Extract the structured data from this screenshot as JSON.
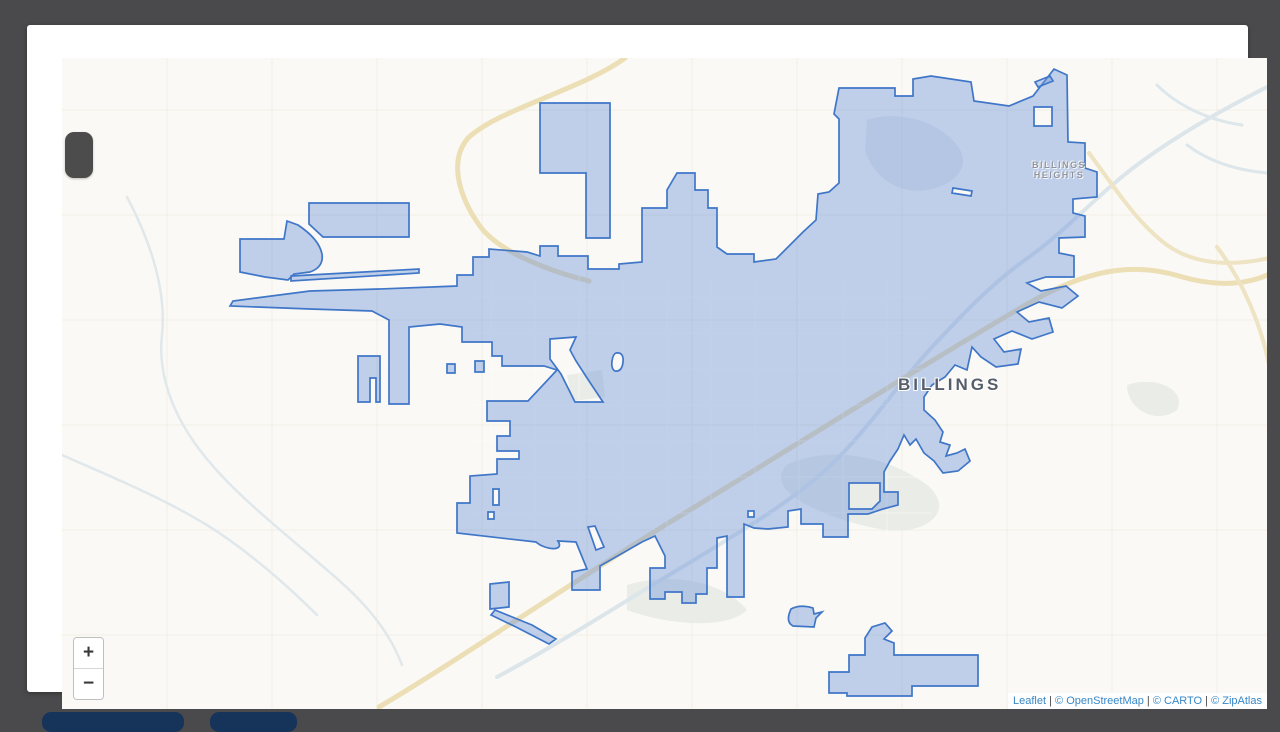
{
  "theme": {
    "page-bg": "#4a4a4c",
    "card-bg": "#ffffff",
    "map-bg": "#faf9f5",
    "poly-fill": "rgba(110,148,216,0.42)",
    "poly-stroke": "#3f76c8",
    "label-dark": "#565e6a",
    "label-light": "#8f949c",
    "link-blue": "#3687c8",
    "btn-navy": "#16335a",
    "pill-gray": "#4c4c4c"
  },
  "map": {
    "city_label": "BILLINGS",
    "heights_label": "BILLINGS\nHEIGHTS",
    "zoom_control": {
      "zoom_in_label": "+",
      "zoom_out_label": "−"
    },
    "attribution": {
      "parts": [
        {
          "text": "Leaflet",
          "link": true
        },
        {
          "text": " | ",
          "link": false
        },
        {
          "text": "© OpenStreetMap",
          "link": true
        },
        {
          "text": " | ",
          "link": false
        },
        {
          "text": "© CARTO",
          "link": true
        },
        {
          "text": " | ",
          "link": false
        },
        {
          "text": "© ZipAtlas",
          "link": true
        }
      ]
    },
    "layers": [
      {
        "name": "section-grid-lines",
        "d": "M140 33V684M245 33V684M350 33V684M455 33V684M560 33V684M665 33V684M770 33V684M875 33V684M980 33V684M1085 33V684M1190 33V684M35 85H1240M35 190H1240M35 295H1240M35 400H1240M35 505H1240M35 610H1240",
        "stroke": "#f1eee5",
        "w": 1
      },
      {
        "name": "land-patches",
        "d": "M760 440C800 420 860 430 900 460C930 485 900 510 860 505C820 500 730 470 760 440Z M540 350L575 345 578 372 545 376Z M600 560C650 545 700 560 720 585C700 605 640 600 600 585Z M1100 360C1130 350 1160 365 1150 385C1130 400 1100 385 1100 360Z",
        "fill": "#e9ece7"
      },
      {
        "name": "terrain-rimrocks",
        "d": "M840 95C870 85 910 95 930 120C945 140 930 160 900 165C870 170 845 150 838 125Z",
        "fill": "#ccd6e0",
        "op": "0.4"
      },
      {
        "name": "river-yellowstone",
        "d": "M1248 58C1200 82 1150 110 1110 140C1070 170 1040 205 1002 232C965 258 935 290 905 322C875 354 848 395 812 432C776 469 725 500 662 538C600 575 530 620 470 652",
        "stroke": "#dce6ea",
        "w": 4
      },
      {
        "name": "river-west-creeks",
        "d": "M100 172C120 210 140 260 135 310C130 355 150 400 185 440C215 475 260 510 300 545C330 570 360 600 375 640 M35 430C80 450 130 470 180 500C220 525 260 560 290 590",
        "stroke": "#e0e8ec",
        "w": 2.5
      },
      {
        "name": "river-ne-braids",
        "d": "M1130 60C1150 80 1180 95 1215 100 M1160 120C1180 135 1205 145 1240 148",
        "stroke": "#dde7eb",
        "w": 3
      },
      {
        "name": "highway-main",
        "d": "M598 33C556 64 472 84 441 113C419 139 436 180 456 205C476 228 522 246 562 256 M352 682C430 636 531 566 648 494C766 422 902 336 1002 278C1056 247 1102 236 1152 251C1196 264 1228 258 1248 246",
        "stroke": "#ecdfb5",
        "w": 5
      },
      {
        "name": "highway-northeast",
        "d": "M1062 128C1088 163 1110 198 1140 220C1168 240 1205 242 1247 232 M1190 222C1215 255 1235 300 1243 345",
        "stroke": "#eee3c2",
        "w": 4
      },
      {
        "name": "street-grid",
        "d": "M464 250V515M508 250V515M552 250V515M596 250V515M640 250V515M684 250V515M728 250V515M772 250V515M816 250V515M860 250V515M440 272H905M440 308H905M440 344H905M440 380H905M440 416H905M440 452H905M440 488H905",
        "stroke": "#ffffff",
        "w": 1.1,
        "op": "0.45"
      },
      {
        "name": "city-boundary-polygon",
        "d": "M203 281L206 276 283 266 352 264 430 261 430 250 446 250 446 232 462 232 462 224 500 227 513 231 513 221 531 221 531 231 561 231 561 244 592 244 592 239 615 237 615 183 640 183 640 165 650 148 668 148 668 165 681 165 681 183 690 183 690 222 700 229 727 229 727 237 749 234 762 221 776 207 789 195 791 169 802 167 812 158 812 94 807 89 812 63 868 63 868 71 886 71 886 54 904 51 944 57 947 76 982 81 1006 71 1027 44 1040 50 1041 117 1058 118 1058 143 1070 147 1070 172 1046 174 1046 188 1058 191 1058 212 1032 213 1032 228 1047 231 1047 252 1019 252 1000 258 1014 266 1039 261 1051 271 1035 283 1012 277 990 287 1002 297 1022 293 1026 307 1005 314 985 306 967 314 977 327 994 324 991 339 969 342 954 332 945 322 940 345 928 340 918 352 905 360 897 372 897 385 908 395 916 407 913 417 923 420 919 431 930 428 938 424 943 436 931 446 916 448 907 436 897 428 889 414 883 420 877 410 871 424 863 436 857 447 857 467 871 467 871 480 856 484 841 489 821 489 821 512 796 512 796 499 774 499 774 484 761 486 761 502 741 504 727 503 717 499 717 572 700 572 700 511 690 513 690 543 680 543 680 569 669 569 669 578 655 578 655 567 638 567 638 574 623 574 623 543 638 543 638 531 628 511 615 517 573 541 573 565 545 565 545 547 560 544 549 517 531 516C538 527 518 525 509 517L430 508 430 478 443 478 443 451 470 449 470 434 492 434 492 426 470 426 470 411 483 411 483 396 460 396 460 376 501 376 530 345 517 341 475 341 475 331 465 331 465 317 435 317 435 302 413 299 382 302 382 379 362 379 362 295 345 286 283 284Z M523 314L549 312 543 325 549 336 562 356 576 377 548 377 534 349 523 334Z M589 328Q597 327 596 337Q595 347 588 346Q584 344 585 336Q586 329 589 328Z M420 339H428V348H420Z M448 336H457V347H448Z M466 464H472V480H466Z M461 487H467V494H461Z M561 502L568 501 577 522 569 525Z M721 486H727V492H721Z M822 458H853V476L845 484H822Z M1007 82H1025V101H1007Z M926 163L945 166 944 171 925 168Z",
        "fill": "rgba(110,148,216,0.42)",
        "stroke": "#3f76c8",
        "w": 1.7,
        "rule": "evenodd"
      },
      {
        "name": "city-boundary-exclaves",
        "d": "M513 78H583V213H559V148H513Z M282 178H382V212H296L282 199Z M213 214L257 214 260 196 271 200Q292 214 295 229Q297 242 283 247L267 249 261 255 238 252 213 247Z M264 251L392 244 392 248 264 256Z M331 331H353V377H349V353H343V377H331Z M1008 57L1023 51 1026 56 1011 62Z M764 584Q758 597 766 601L787 602 789 593 795 587 787 589 786 583Q773 579 764 584Z M822 630H838V613L845 602 858 598 865 606 857 614 867 618V630H951V661H885V671H820V668H802V647H822Z M463 559L482 557V582L463 584Z M468 585L505 600 529 614 522 619 489 602 464 590Z",
        "fill": "rgba(110,148,216,0.42)",
        "stroke": "#3f76c8",
        "w": 1.7
      }
    ]
  }
}
